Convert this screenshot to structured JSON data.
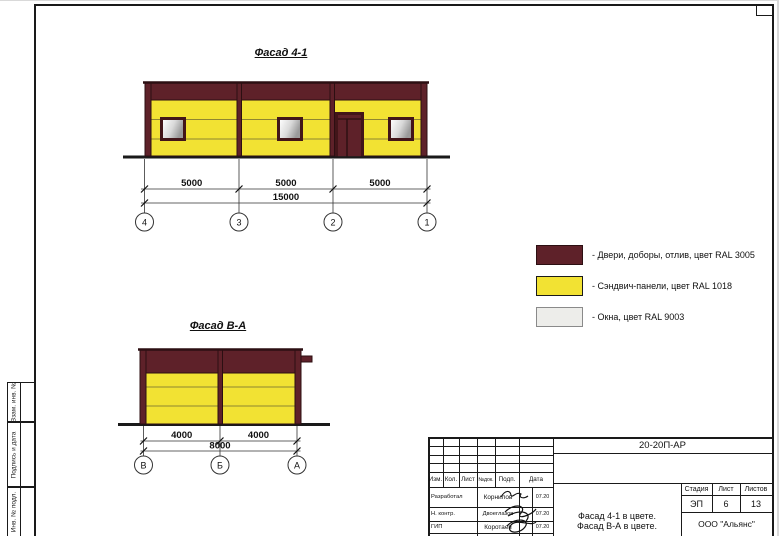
{
  "drawing": {
    "facade_top": {
      "title": "Фасад 4-1",
      "dims": [
        "5000",
        "5000",
        "5000"
      ],
      "total": "15000",
      "axes": [
        "4",
        "3",
        "2",
        "1"
      ]
    },
    "facade_side": {
      "title": "Фасад В-А",
      "dims": [
        "4000",
        "4000"
      ],
      "total": "8000",
      "axes": [
        "В",
        "Б",
        "А"
      ]
    },
    "legend": {
      "items": [
        {
          "name": "doors",
          "color": "#5E2129",
          "label": "- Двери, доборы, отлив, цвет RAL 3005"
        },
        {
          "name": "panels",
          "color": "#F2E233",
          "label": "- Сэндвич-панели, цвет RAL 1018"
        },
        {
          "name": "windows",
          "color": "#EDEDEA",
          "label": "- Окна, цвет RAL 9003"
        }
      ]
    }
  },
  "frame_sidebar": {
    "labels": [
      "Взам. инв. №",
      "Подпись и дата",
      "Инв. № подл."
    ]
  },
  "title_block": {
    "doc_code": "20-20П-АР",
    "columns": [
      "Изм.",
      "Кол.",
      "Лист",
      "№док.",
      "Подп.",
      "Дата"
    ],
    "rows": [
      {
        "role": "Разработал",
        "name": "Корнилов",
        "date": "07.20"
      },
      {
        "role": "Н. контр.",
        "name": "Двоеглазов",
        "date": "07.20"
      },
      {
        "role": "ГИП",
        "name": "Коротаев",
        "date": "07.20"
      }
    ],
    "subject_line1": "Фасад 4-1 в цвете.",
    "subject_line2": "Фасад В-А в цвете.",
    "stage_label": "Стадия",
    "sheet_label": "Лист",
    "sheets_label": "Листов",
    "stage": "ЭП",
    "sheet": "6",
    "sheets": "13",
    "company": "ООО \"Альянс\""
  },
  "colors": {
    "maroon": "#5E2129",
    "yellow": "#F2E233",
    "window": "#EDEDEA",
    "outline": "#2C0F12"
  }
}
